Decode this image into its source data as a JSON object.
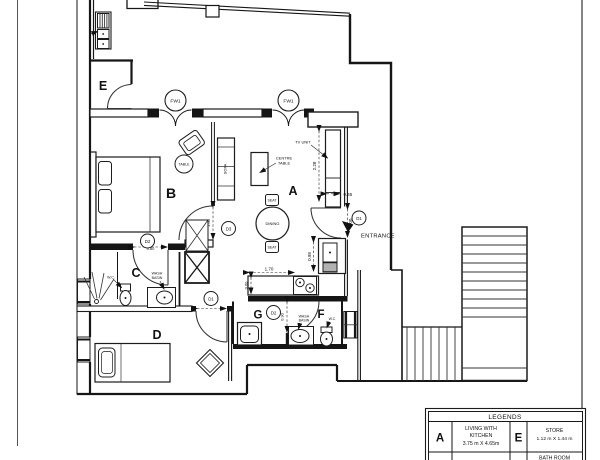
{
  "rooms": {
    "a": "A",
    "b": "B",
    "c": "C",
    "d": "D",
    "e": "E",
    "f": "F",
    "g": "G"
  },
  "doors": {
    "entrance": "D1",
    "living": "D3",
    "bath": "D2",
    "bedroom": "D1",
    "utility": "D2"
  },
  "windows": {
    "left": "FW1",
    "right": "FW1"
  },
  "labels": {
    "entrance": "ENTRANCE",
    "tv_unit": "TV UNIT",
    "centre_table_line1": "CENTRE",
    "centre_table_line2": "TABLE",
    "sofa": "SOFA",
    "round_table": "TABLE",
    "seat_top": "SEAT",
    "seat_bottom": "SEAT",
    "dining": "DINING",
    "wc_bath": "W.C.",
    "wash_basin_line1": "WASH",
    "wash_basin_line2": "BASIN",
    "wc_toilet": "W.C",
    "wash_basin_f_line1": "WASH",
    "wash_basin_f_line2": "BASIN"
  },
  "dimensions": {
    "tv_length": "2.28",
    "tv_depth": "0.45",
    "entrance_width": "1.00",
    "sink_run": "0.98",
    "counter_length": "1.70",
    "counter_depth": "0.60",
    "living_door": "1.00",
    "bath_door": "0.80",
    "bedroom_door": "1.00",
    "utility_door": "0.90"
  },
  "legend": {
    "header": "LEGENDS",
    "rows": [
      {
        "key": "A",
        "name_line1": "LIVING  WITH",
        "name_line2": "KITCHEN",
        "size": "3.75 m X 4.65m"
      },
      {
        "key": "E",
        "name_line1": "STORE",
        "size": "1.12 m X 1.44 m"
      },
      {
        "key": "",
        "name_line1": "BATH ROOM",
        "name_line2": "",
        "size": ""
      }
    ]
  }
}
